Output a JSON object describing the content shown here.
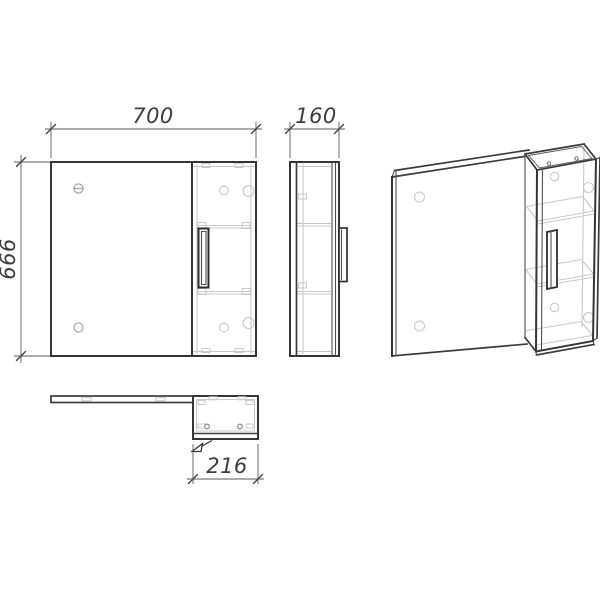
{
  "drawing": {
    "background": "#ffffff",
    "colors": {
      "main_line": "#353535",
      "light_line": "#c9c9c9",
      "medium_line": "#9f9f9f",
      "dimension_text": "#3d3d3d"
    },
    "dimensions": {
      "front_width": "700",
      "front_height": "666",
      "side_depth": "160",
      "top_cabinet_width": "216"
    }
  }
}
